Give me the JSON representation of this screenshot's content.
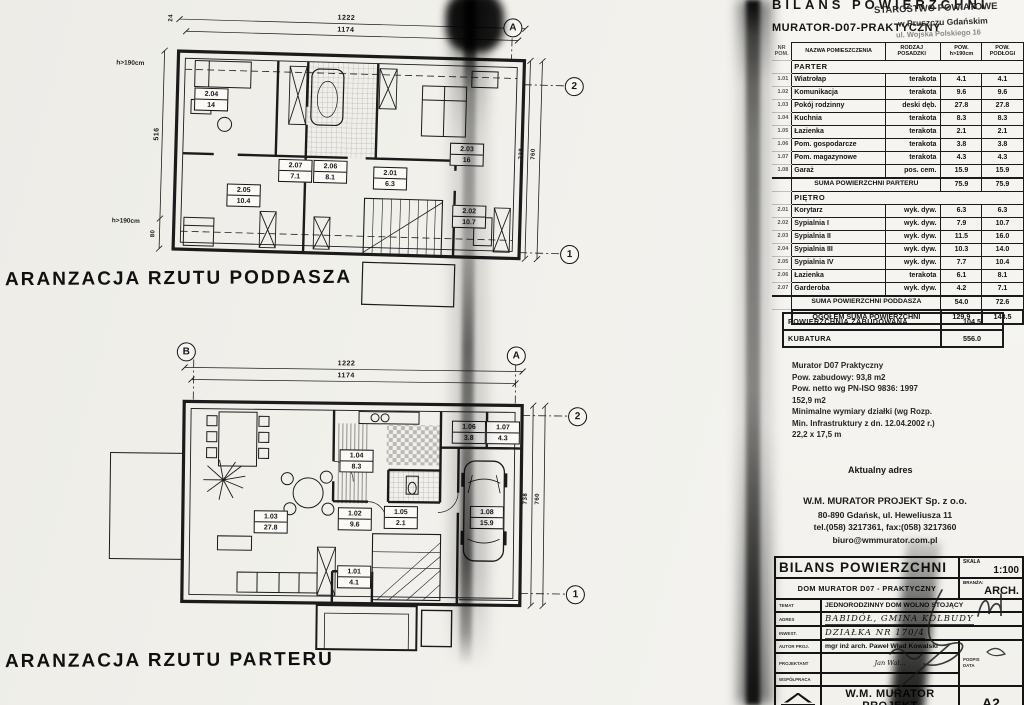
{
  "plans": {
    "attic": {
      "title": "ARANZACJA RZUTU PODDASZA",
      "grid": {
        "a": "A",
        "n1": "1",
        "n2": "2"
      },
      "dims": {
        "w_out": "1222",
        "w_in": "1174",
        "h_left": "516",
        "h_left2": "80",
        "tick": "24",
        "h_right_in": "738",
        "h_right_out": "760"
      },
      "knee": "h>190cm",
      "rooms": [
        {
          "nr": "2.04",
          "area": "14"
        },
        {
          "nr": "2.03",
          "area": "16"
        },
        {
          "nr": "2.07",
          "area": "7.1"
        },
        {
          "nr": "2.06",
          "area": "8.1"
        },
        {
          "nr": "2.01",
          "area": "6.3"
        },
        {
          "nr": "2.05",
          "area": "10.4"
        },
        {
          "nr": "2.02",
          "area": "10.7"
        }
      ]
    },
    "ground": {
      "title": "ARANZACJA RZUTU PARTERU",
      "grid": {
        "a": "A",
        "b": "B",
        "n1": "1",
        "n2": "2"
      },
      "dims": {
        "w_out": "1222",
        "w_in": "1174",
        "h_right_in": "738",
        "h_right_out": "760"
      },
      "rooms": [
        {
          "nr": "1.06",
          "area": "3.8"
        },
        {
          "nr": "1.07",
          "area": "4.3"
        },
        {
          "nr": "1.04",
          "area": "8.3"
        },
        {
          "nr": "1.03",
          "area": "27.8"
        },
        {
          "nr": "1.02",
          "area": "9.6"
        },
        {
          "nr": "1.05",
          "area": "2.1"
        },
        {
          "nr": "1.01",
          "area": "4.1"
        },
        {
          "nr": "1.08",
          "area": "15.9"
        }
      ]
    }
  },
  "panel": {
    "header": {
      "title": "BILANS POWIERZCHNI",
      "subtitle": "MURATOR-D07-PRAKTYCZNY"
    },
    "stamp": {
      "l1": "STAROSTWO POWIATOWE",
      "l2": "w Pruszczu Gdańskim",
      "l3": "ul. Wojska Polskiego 16"
    },
    "table": {
      "col_nr": "NR POM.",
      "col_nazwa": "NAZWA POMIESZCZENIA",
      "col_rodzaj": "RODZAJ POSADZKI",
      "col_pow1": "POW. h>190cm",
      "col_pow2": "POW. PODŁOGI",
      "sections": [
        {
          "name": "PARTER",
          "rows": [
            {
              "nr": "1.01",
              "nazwa": "Wiatrołap",
              "rodzaj": "terakota",
              "pow1": "4.1",
              "pow2": "4.1"
            },
            {
              "nr": "1.02",
              "nazwa": "Komunikacja",
              "rodzaj": "terakota",
              "pow1": "9.6",
              "pow2": "9.6"
            },
            {
              "nr": "1.03",
              "nazwa": "Pokój rodzinny",
              "rodzaj": "deski dęb.",
              "pow1": "27.8",
              "pow2": "27.8"
            },
            {
              "nr": "1.04",
              "nazwa": "Kuchnia",
              "rodzaj": "terakota",
              "pow1": "8.3",
              "pow2": "8.3"
            },
            {
              "nr": "1.05",
              "nazwa": "Łazienka",
              "rodzaj": "terakota",
              "pow1": "2.1",
              "pow2": "2.1"
            },
            {
              "nr": "1.06",
              "nazwa": "Pom. gospodarcze",
              "rodzaj": "terakota",
              "pow1": "3.8",
              "pow2": "3.8"
            },
            {
              "nr": "1.07",
              "nazwa": "Pom. magazynowe",
              "rodzaj": "terakota",
              "pow1": "4.3",
              "pow2": "4.3"
            },
            {
              "nr": "1.08",
              "nazwa": "Garaż",
              "rodzaj": "pos. cem.",
              "pow1": "15.9",
              "pow2": "15.9"
            }
          ],
          "suma_label": "SUMA POWIERZCHNI PARTERU",
          "suma1": "75.9",
          "suma2": "75.9"
        },
        {
          "name": "PIĘTRO",
          "rows": [
            {
              "nr": "2.01",
              "nazwa": "Korytarz",
              "rodzaj": "wyk. dyw.",
              "pow1": "6.3",
              "pow2": "6.3"
            },
            {
              "nr": "2.02",
              "nazwa": "Sypialnia I",
              "rodzaj": "wyk. dyw.",
              "pow1": "7.9",
              "pow2": "10.7"
            },
            {
              "nr": "2.03",
              "nazwa": "Sypialnia II",
              "rodzaj": "wyk. dyw.",
              "pow1": "11.5",
              "pow2": "16.0"
            },
            {
              "nr": "2.04",
              "nazwa": "Sypialnia III",
              "rodzaj": "wyk. dyw.",
              "pow1": "10.3",
              "pow2": "14.0"
            },
            {
              "nr": "2.05",
              "nazwa": "Sypialnia IV",
              "rodzaj": "wyk. dyw.",
              "pow1": "7.7",
              "pow2": "10.4"
            },
            {
              "nr": "2.06",
              "nazwa": "Łazienka",
              "rodzaj": "terakota",
              "pow1": "6.1",
              "pow2": "8.1"
            },
            {
              "nr": "2.07",
              "nazwa": "Garderoba",
              "rodzaj": "wyk. dyw.",
              "pow1": "4.2",
              "pow2": "7.1"
            }
          ],
          "suma_label": "SUMA POWIERZCHNI PODDASZA",
          "suma1": "54.0",
          "suma2": "72.6"
        }
      ],
      "total": {
        "label": "OGÓŁEM SUMA POWIERZCHNI",
        "pow1": "129.9",
        "pow2": "148.5"
      }
    },
    "summary": {
      "zab_label": "POWIERZCHNIA ZABUDOWANA",
      "zab": "104.5",
      "kub_label": "KUBATURA",
      "kub": "556.0"
    },
    "specs": {
      "l1": "Murator D07 Praktyczny",
      "l2": "Pow. zabudowy: 93,8 m2",
      "l3": "Pow. netto wg PN-ISO 9836: 1997",
      "l4": "152,9 m2",
      "l5": "Minimalne wymiary działki (wg Rozp.",
      "l6": "Min. Infrastruktury z dn. 12.04.2002 r.)",
      "l7": "22,2 x 17,5 m"
    },
    "address": {
      "heading": "Aktualny adres",
      "l1": "W.M. MURATOR PROJEKT Sp. z o.o.",
      "l2": "80-890 Gdańsk, ul. Heweliusza 11",
      "l3": "tel.(058) 3217361, fax:(058) 3217360",
      "l4": "biuro@wmmurator.com.pl"
    },
    "titleblock": {
      "title": "BILANS POWIERZCHNI",
      "skala_label": "SKALA",
      "skala": "1:100",
      "project": "DOM MURATOR D07 - PRAKTYCZNY",
      "branza_label": "BRANŻA:",
      "branza": "ARCH.",
      "temat_label": "TEMAT",
      "temat": "JEDNORODZINNY DOM WOLNO STOJĄCY",
      "adres_label": "ADRES",
      "adres": "BABIDÓŁ, GMINA KOLBUDY",
      "inwest_label": "INWEST.",
      "inwest": "DZIAŁKA NR 170/4",
      "autor_label": "AUTOR PROJ.",
      "autor": "mgr inż arch. Paweł Wład Kowalski",
      "projektant_label": "PROJEKTANT",
      "projektant": "Jan Wal...",
      "wspolpraca_label": "WSPÓŁPRACA",
      "wspolpraca": "",
      "podpis": "PODPIS",
      "data": "DATA",
      "logo": "murator",
      "company": "W.M. MURATOR PROJEKT",
      "company2": "Sp. z o.o.",
      "format": "A2",
      "footer": "80-264 GDAŃSK, Klonowa Tel +(58) 3476647"
    }
  }
}
